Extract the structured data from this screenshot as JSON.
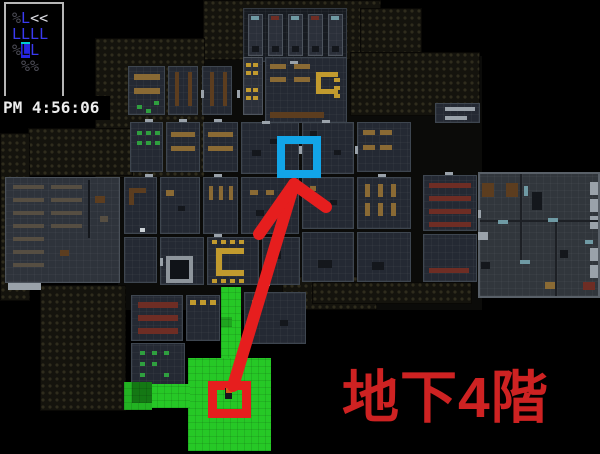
{
  "hud": {
    "lines": [
      {
        "segs": [
          {
            "t": "%",
            "c": "dim"
          },
          {
            "t": "L",
            "c": "unit"
          },
          {
            "t": "<<",
            "c": "bright"
          }
        ]
      },
      {
        "segs": [
          {
            "t": "LLLL",
            "c": "unit"
          }
        ]
      },
      {
        "segs": [
          {
            "t": "%",
            "c": "dim"
          },
          {
            "t": "L",
            "c": "sel"
          },
          {
            "t": "L",
            "c": "unit"
          }
        ]
      },
      {
        "segs": [
          {
            "t": " %%",
            "c": "dim"
          }
        ]
      }
    ],
    "clock": "PM 4:56:06",
    "colors": {
      "dim": "#4b4b55",
      "unit": "#3a3af0",
      "bright": "#dcdce2",
      "sel_bg": "#2626e0",
      "sel_fg": "#06060a",
      "sel_tick": "#00ced2",
      "panel_border": "#b6b6b6"
    }
  },
  "annotations": {
    "floor_label": {
      "text": "地下4階",
      "color": "#ce2222"
    },
    "arrow": {
      "color": "#e61e1e",
      "width": 12,
      "shaft_from": [
        233,
        386
      ],
      "tip": [
        294,
        184
      ],
      "barb_left": [
        259,
        234
      ],
      "barb_right": [
        326,
        207
      ]
    },
    "markers": [
      {
        "name": "stairs-room-marker",
        "x": 166,
        "y": 256,
        "w": 27,
        "h": 27,
        "border": 4,
        "color": "#8e959c",
        "fill": "#101318"
      },
      {
        "name": "destination-marker",
        "x": 277,
        "y": 136,
        "w": 44,
        "h": 42,
        "border": 8,
        "color": "#12a5e8",
        "fill": "transparent"
      },
      {
        "name": "player-marker",
        "x": 208,
        "y": 381,
        "w": 43,
        "h": 37,
        "border": 9,
        "color": "#e61e1e",
        "fill": "transparent"
      }
    ],
    "route_zones": [
      [
        221,
        287,
        20,
        76,
        "#26c826"
      ],
      [
        221,
        317,
        11,
        10,
        "#1fa51f"
      ],
      [
        188,
        358,
        83,
        93,
        "#26c826"
      ],
      [
        150,
        384,
        40,
        24,
        "#26c826"
      ],
      [
        124,
        382,
        28,
        28,
        "#22b322"
      ],
      [
        132,
        382,
        20,
        21,
        "#147814"
      ]
    ],
    "player_sprite": {
      "x": 225,
      "y": 388,
      "body": "#17181d",
      "head": "#cf5d16"
    }
  },
  "map": {
    "backdrop": [
      118,
      56,
      364,
      254
    ],
    "palette": {
      "tan": "#8a6a34",
      "brown": "#5c3d1f",
      "dred": "#6e2d24",
      "yell": "#c19a2e",
      "grn": "#2f9f3f",
      "lite": "#9aa2aa",
      "dark": "#14171c",
      "shelf": "#564e42",
      "white": "#ccd2d6",
      "teal": "#6f9aa4",
      "wall2": "#1d2025"
    },
    "walls": [
      [
        203,
        0,
        178,
        60
      ],
      [
        95,
        38,
        110,
        140
      ],
      [
        360,
        8,
        62,
        50
      ],
      [
        350,
        52,
        130,
        64
      ],
      [
        28,
        128,
        105,
        48
      ],
      [
        0,
        133,
        30,
        168
      ],
      [
        40,
        285,
        86,
        126
      ],
      [
        282,
        276,
        95,
        34
      ],
      [
        312,
        282,
        160,
        22
      ]
    ],
    "rooms": [
      [
        243,
        8,
        104,
        54,
        "block"
      ],
      [
        248,
        14,
        15,
        42,
        "cell"
      ],
      [
        268,
        14,
        15,
        42,
        "cell"
      ],
      [
        288,
        14,
        15,
        42,
        "cell"
      ],
      [
        308,
        14,
        15,
        42,
        "cell"
      ],
      [
        328,
        14,
        15,
        42,
        "cell"
      ],
      [
        128,
        66,
        37,
        49
      ],
      [
        168,
        66,
        30,
        49
      ],
      [
        202,
        66,
        30,
        49
      ],
      [
        243,
        57,
        20,
        58,
        "cell"
      ],
      [
        265,
        57,
        82,
        66
      ],
      [
        130,
        122,
        33,
        50
      ],
      [
        166,
        122,
        34,
        50
      ],
      [
        203,
        122,
        35,
        50
      ],
      [
        241,
        122,
        58,
        52
      ],
      [
        302,
        122,
        52,
        52
      ],
      [
        357,
        122,
        54,
        50
      ],
      [
        5,
        177,
        115,
        106,
        "light"
      ],
      [
        124,
        177,
        33,
        57
      ],
      [
        160,
        177,
        40,
        57
      ],
      [
        203,
        177,
        35,
        57
      ],
      [
        241,
        177,
        58,
        57
      ],
      [
        302,
        177,
        52,
        52
      ],
      [
        357,
        177,
        54,
        52
      ],
      [
        423,
        175,
        54,
        56
      ],
      [
        124,
        237,
        33,
        46
      ],
      [
        160,
        237,
        44,
        48
      ],
      [
        207,
        237,
        52,
        48
      ],
      [
        262,
        237,
        38,
        48
      ],
      [
        302,
        232,
        52,
        50
      ],
      [
        357,
        232,
        54,
        50
      ],
      [
        423,
        234,
        54,
        48
      ],
      [
        478,
        172,
        122,
        126,
        "rcx"
      ],
      [
        131,
        295,
        52,
        46
      ],
      [
        186,
        295,
        34,
        46
      ],
      [
        131,
        343,
        54,
        46
      ],
      [
        244,
        292,
        62,
        52
      ],
      [
        435,
        103,
        45,
        20
      ]
    ],
    "furniture": [
      [
        252,
        46,
        7,
        6,
        "dark"
      ],
      [
        272,
        46,
        7,
        6,
        "dark"
      ],
      [
        292,
        46,
        7,
        6,
        "dark"
      ],
      [
        312,
        46,
        7,
        6,
        "dark"
      ],
      [
        332,
        46,
        7,
        6,
        "dark"
      ],
      [
        251,
        16,
        8,
        4,
        "teal"
      ],
      [
        291,
        16,
        8,
        4,
        "teal"
      ],
      [
        331,
        16,
        8,
        4,
        "teal"
      ],
      [
        271,
        16,
        8,
        4,
        "dred"
      ],
      [
        311,
        16,
        8,
        4,
        "dred"
      ],
      [
        134,
        74,
        26,
        6,
        "tan"
      ],
      [
        134,
        88,
        26,
        6,
        "tan"
      ],
      [
        137,
        105,
        5,
        4,
        "grn"
      ],
      [
        146,
        109,
        5,
        4,
        "grn"
      ],
      [
        154,
        101,
        5,
        4,
        "grn"
      ],
      [
        175,
        72,
        4,
        34,
        "brown"
      ],
      [
        188,
        72,
        4,
        34,
        "brown"
      ],
      [
        210,
        72,
        4,
        34,
        "brown"
      ],
      [
        223,
        72,
        4,
        34,
        "brown"
      ],
      [
        246,
        63,
        5,
        4,
        "yell"
      ],
      [
        253,
        63,
        5,
        4,
        "yell"
      ],
      [
        246,
        71,
        5,
        4,
        "yell"
      ],
      [
        253,
        71,
        5,
        4,
        "yell"
      ],
      [
        246,
        88,
        5,
        4,
        "yell"
      ],
      [
        253,
        88,
        5,
        4,
        "yell"
      ],
      [
        246,
        96,
        5,
        4,
        "yell"
      ],
      [
        253,
        96,
        5,
        4,
        "yell"
      ],
      [
        270,
        64,
        16,
        5,
        "tan"
      ],
      [
        294,
        64,
        16,
        5,
        "tan"
      ],
      [
        270,
        77,
        16,
        5,
        "tan"
      ],
      [
        294,
        77,
        16,
        5,
        "tan"
      ],
      [
        316,
        72,
        5,
        22,
        "yell"
      ],
      [
        316,
        72,
        22,
        5,
        "yell"
      ],
      [
        316,
        89,
        22,
        5,
        "yell"
      ],
      [
        334,
        78,
        6,
        4,
        "yell"
      ],
      [
        334,
        86,
        6,
        4,
        "yell"
      ],
      [
        334,
        94,
        6,
        4,
        "yell"
      ],
      [
        270,
        112,
        54,
        6,
        "brown"
      ],
      [
        137,
        131,
        5,
        4,
        "grn"
      ],
      [
        146,
        131,
        5,
        4,
        "grn"
      ],
      [
        155,
        131,
        5,
        4,
        "grn"
      ],
      [
        137,
        141,
        5,
        4,
        "grn"
      ],
      [
        146,
        141,
        5,
        4,
        "grn"
      ],
      [
        155,
        141,
        5,
        4,
        "grn"
      ],
      [
        171,
        132,
        24,
        5,
        "tan"
      ],
      [
        171,
        146,
        24,
        5,
        "tan"
      ],
      [
        208,
        132,
        25,
        5,
        "tan"
      ],
      [
        208,
        146,
        25,
        5,
        "tan"
      ],
      [
        252,
        150,
        9,
        6,
        "dark"
      ],
      [
        270,
        139,
        7,
        5,
        "dark"
      ],
      [
        310,
        131,
        7,
        5,
        "dark"
      ],
      [
        334,
        150,
        7,
        5,
        "dark"
      ],
      [
        363,
        130,
        12,
        5,
        "tan"
      ],
      [
        380,
        130,
        12,
        5,
        "tan"
      ],
      [
        363,
        145,
        12,
        5,
        "tan"
      ],
      [
        380,
        145,
        12,
        5,
        "tan"
      ],
      [
        13,
        185,
        31,
        4,
        "shelf"
      ],
      [
        13,
        198,
        31,
        4,
        "shelf"
      ],
      [
        13,
        211,
        31,
        4,
        "shelf"
      ],
      [
        13,
        224,
        31,
        4,
        "shelf"
      ],
      [
        13,
        237,
        31,
        4,
        "shelf"
      ],
      [
        13,
        250,
        31,
        4,
        "shelf"
      ],
      [
        13,
        263,
        31,
        4,
        "shelf"
      ],
      [
        51,
        185,
        31,
        4,
        "shelf"
      ],
      [
        51,
        198,
        31,
        4,
        "shelf"
      ],
      [
        51,
        211,
        31,
        4,
        "shelf"
      ],
      [
        51,
        224,
        31,
        4,
        "shelf"
      ],
      [
        88,
        180,
        2,
        58,
        "dark"
      ],
      [
        95,
        196,
        10,
        7,
        "brown"
      ],
      [
        100,
        216,
        8,
        6,
        "shelf"
      ],
      [
        60,
        250,
        9,
        6,
        "brown"
      ],
      [
        8,
        283,
        33,
        7,
        "lite"
      ],
      [
        129,
        188,
        17,
        5,
        "brown"
      ],
      [
        129,
        188,
        5,
        17,
        "brown"
      ],
      [
        140,
        228,
        5,
        4,
        "white"
      ],
      [
        166,
        190,
        8,
        6,
        "tan"
      ],
      [
        178,
        206,
        7,
        5,
        "dark"
      ],
      [
        209,
        186,
        4,
        14,
        "tan"
      ],
      [
        219,
        186,
        4,
        14,
        "tan"
      ],
      [
        229,
        186,
        4,
        14,
        "tan"
      ],
      [
        250,
        190,
        8,
        5,
        "tan"
      ],
      [
        266,
        190,
        8,
        5,
        "tan"
      ],
      [
        256,
        210,
        8,
        6,
        "dark"
      ],
      [
        310,
        186,
        6,
        5,
        "tan"
      ],
      [
        330,
        200,
        7,
        5,
        "dark"
      ],
      [
        365,
        184,
        5,
        13,
        "tan"
      ],
      [
        378,
        184,
        5,
        13,
        "tan"
      ],
      [
        391,
        184,
        5,
        13,
        "tan"
      ],
      [
        365,
        203,
        5,
        13,
        "tan"
      ],
      [
        378,
        203,
        5,
        13,
        "tan"
      ],
      [
        391,
        203,
        5,
        13,
        "tan"
      ],
      [
        429,
        183,
        42,
        5,
        "dred"
      ],
      [
        429,
        196,
        42,
        5,
        "dred"
      ],
      [
        429,
        209,
        42,
        5,
        "dred"
      ],
      [
        429,
        222,
        42,
        5,
        "dred"
      ],
      [
        216,
        248,
        6,
        28,
        "yell"
      ],
      [
        216,
        248,
        28,
        6,
        "yell"
      ],
      [
        216,
        270,
        28,
        6,
        "yell"
      ],
      [
        212,
        240,
        5,
        4,
        "yell"
      ],
      [
        221,
        240,
        5,
        4,
        "yell"
      ],
      [
        230,
        240,
        5,
        4,
        "yell"
      ],
      [
        239,
        240,
        5,
        4,
        "yell"
      ],
      [
        212,
        279,
        5,
        4,
        "yell"
      ],
      [
        221,
        279,
        5,
        4,
        "yell"
      ],
      [
        230,
        279,
        5,
        4,
        "yell"
      ],
      [
        239,
        279,
        5,
        4,
        "yell"
      ],
      [
        272,
        251,
        9,
        8,
        "dark"
      ],
      [
        318,
        260,
        14,
        8,
        "dark"
      ],
      [
        372,
        262,
        12,
        8,
        "dark"
      ],
      [
        429,
        268,
        40,
        5,
        "dred"
      ],
      [
        482,
        183,
        12,
        14,
        "brown"
      ],
      [
        506,
        183,
        12,
        14,
        "brown"
      ],
      [
        532,
        192,
        10,
        18,
        "dark"
      ],
      [
        590,
        182,
        8,
        13,
        "lite"
      ],
      [
        590,
        199,
        8,
        13,
        "lite"
      ],
      [
        590,
        216,
        8,
        13,
        "lite"
      ],
      [
        590,
        248,
        8,
        13,
        "lite"
      ],
      [
        590,
        265,
        8,
        13,
        "lite"
      ],
      [
        520,
        174,
        2,
        46,
        "wall2"
      ],
      [
        480,
        220,
        118,
        2,
        "wall2"
      ],
      [
        555,
        222,
        2,
        74,
        "wall2"
      ],
      [
        520,
        222,
        2,
        40,
        "wall2"
      ],
      [
        524,
        186,
        4,
        10,
        "teal"
      ],
      [
        548,
        218,
        10,
        4,
        "teal"
      ],
      [
        498,
        220,
        10,
        4,
        "teal"
      ],
      [
        585,
        240,
        8,
        4,
        "teal"
      ],
      [
        520,
        260,
        10,
        4,
        "teal"
      ],
      [
        545,
        282,
        10,
        7,
        "tan"
      ],
      [
        583,
        282,
        12,
        8,
        "dred"
      ],
      [
        478,
        232,
        10,
        8,
        "lite"
      ],
      [
        481,
        262,
        9,
        7,
        "dark"
      ],
      [
        560,
        250,
        8,
        8,
        "dark"
      ],
      [
        138,
        302,
        40,
        6,
        "dred"
      ],
      [
        138,
        315,
        40,
        6,
        "dred"
      ],
      [
        138,
        328,
        40,
        6,
        "dred"
      ],
      [
        140,
        351,
        5,
        4,
        "grn"
      ],
      [
        152,
        351,
        5,
        4,
        "grn"
      ],
      [
        164,
        351,
        5,
        4,
        "grn"
      ],
      [
        140,
        362,
        5,
        4,
        "grn"
      ],
      [
        152,
        362,
        5,
        4,
        "grn"
      ],
      [
        164,
        373,
        5,
        4,
        "grn"
      ],
      [
        140,
        373,
        5,
        4,
        "grn"
      ],
      [
        190,
        300,
        6,
        5,
        "yell"
      ],
      [
        200,
        300,
        6,
        5,
        "yell"
      ],
      [
        210,
        300,
        6,
        5,
        "yell"
      ],
      [
        252,
        300,
        8,
        5,
        "tan"
      ],
      [
        280,
        320,
        8,
        6,
        "dark"
      ],
      [
        445,
        107,
        30,
        4,
        "lite"
      ],
      [
        445,
        116,
        22,
        4,
        "lite"
      ],
      [
        145,
        119,
        8,
        3,
        "lite"
      ],
      [
        179,
        119,
        8,
        3,
        "lite"
      ],
      [
        214,
        119,
        8,
        3,
        "lite"
      ],
      [
        262,
        121,
        8,
        3,
        "lite"
      ],
      [
        322,
        120,
        8,
        3,
        "lite"
      ],
      [
        145,
        174,
        8,
        3,
        "lite"
      ],
      [
        214,
        174,
        8,
        3,
        "lite"
      ],
      [
        299,
        146,
        3,
        8,
        "lite"
      ],
      [
        355,
        146,
        3,
        8,
        "lite"
      ],
      [
        378,
        174,
        8,
        3,
        "lite"
      ],
      [
        445,
        172,
        8,
        3,
        "lite"
      ],
      [
        478,
        210,
        3,
        8,
        "lite"
      ],
      [
        214,
        234,
        8,
        3,
        "lite"
      ],
      [
        160,
        258,
        3,
        8,
        "lite"
      ],
      [
        262,
        283,
        8,
        3,
        "lite"
      ],
      [
        290,
        61,
        8,
        3,
        "lite"
      ],
      [
        201,
        90,
        3,
        8,
        "lite"
      ],
      [
        237,
        90,
        3,
        8,
        "lite"
      ]
    ]
  }
}
